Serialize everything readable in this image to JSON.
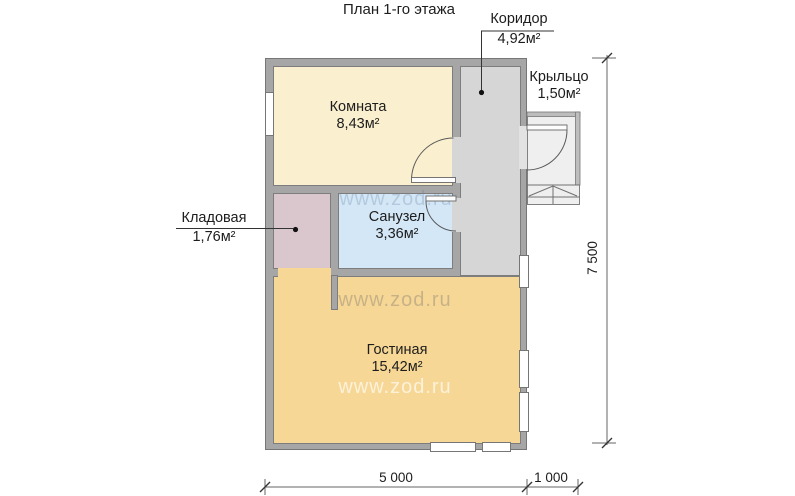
{
  "title": "План 1-го этажа",
  "watermark": "www.zod.ru",
  "rooms": {
    "komnata": {
      "name": "Комната",
      "area": "8,43м²"
    },
    "koridor": {
      "name": "Коридор",
      "area": "4,92м²"
    },
    "kryltso": {
      "name": "Крыльцо",
      "area": "1,50м²"
    },
    "kladovaya": {
      "name": "Кладовая",
      "area": "1,76м²"
    },
    "sanuzel": {
      "name": "Санузел",
      "area": "3,36м²"
    },
    "gostinaya": {
      "name": "Гостиная",
      "area": "15,42м²"
    }
  },
  "dimensions": {
    "width_main": "5 000",
    "width_porch": "1 000",
    "height_total": "7 500"
  },
  "colors": {
    "wall": "#a6a6a6",
    "komnata": "#faf0cf",
    "koridor": "#d6d6d6",
    "kladovaya": "#d9c7cd",
    "sanuzel": "#d3e7f7",
    "gostinaya": "#f7d795",
    "kryltso": "#efefef"
  }
}
